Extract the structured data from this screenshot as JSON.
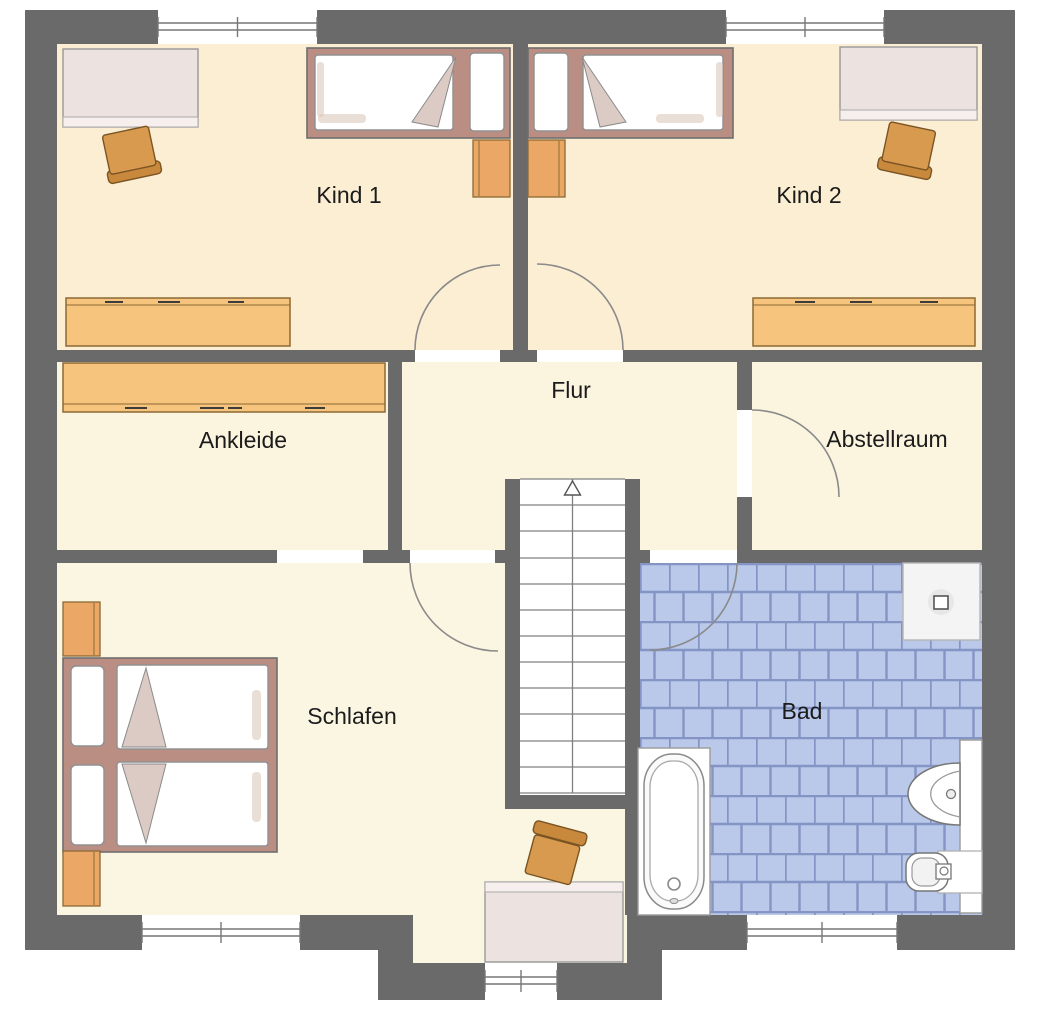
{
  "floorplan": {
    "title": "Obergeschoss Grundriss",
    "rooms": {
      "kind1": {
        "label": "Kind 1"
      },
      "kind2": {
        "label": "Kind 2"
      },
      "ankleide": {
        "label": "Ankleide"
      },
      "flur": {
        "label": "Flur"
      },
      "abstellraum": {
        "label": "Abstellraum"
      },
      "schlafen": {
        "label": "Schlafen"
      },
      "bad": {
        "label": "Bad"
      }
    },
    "colors": {
      "wall": "#6a6a6a",
      "kids_floor": "#fceed3",
      "middle_floor": "#fbf4df",
      "schlafen_floor": "#fbf6e2",
      "tile_fill": "#bac9e9",
      "tile_grout": "#8494c4",
      "furniture_wood": "#f6c47d",
      "chair_wood": "#d89a4f",
      "bed_frame": "#bb8e84",
      "blanket_fold": "#dccbc5",
      "desk_fill": "#ece2df"
    }
  }
}
